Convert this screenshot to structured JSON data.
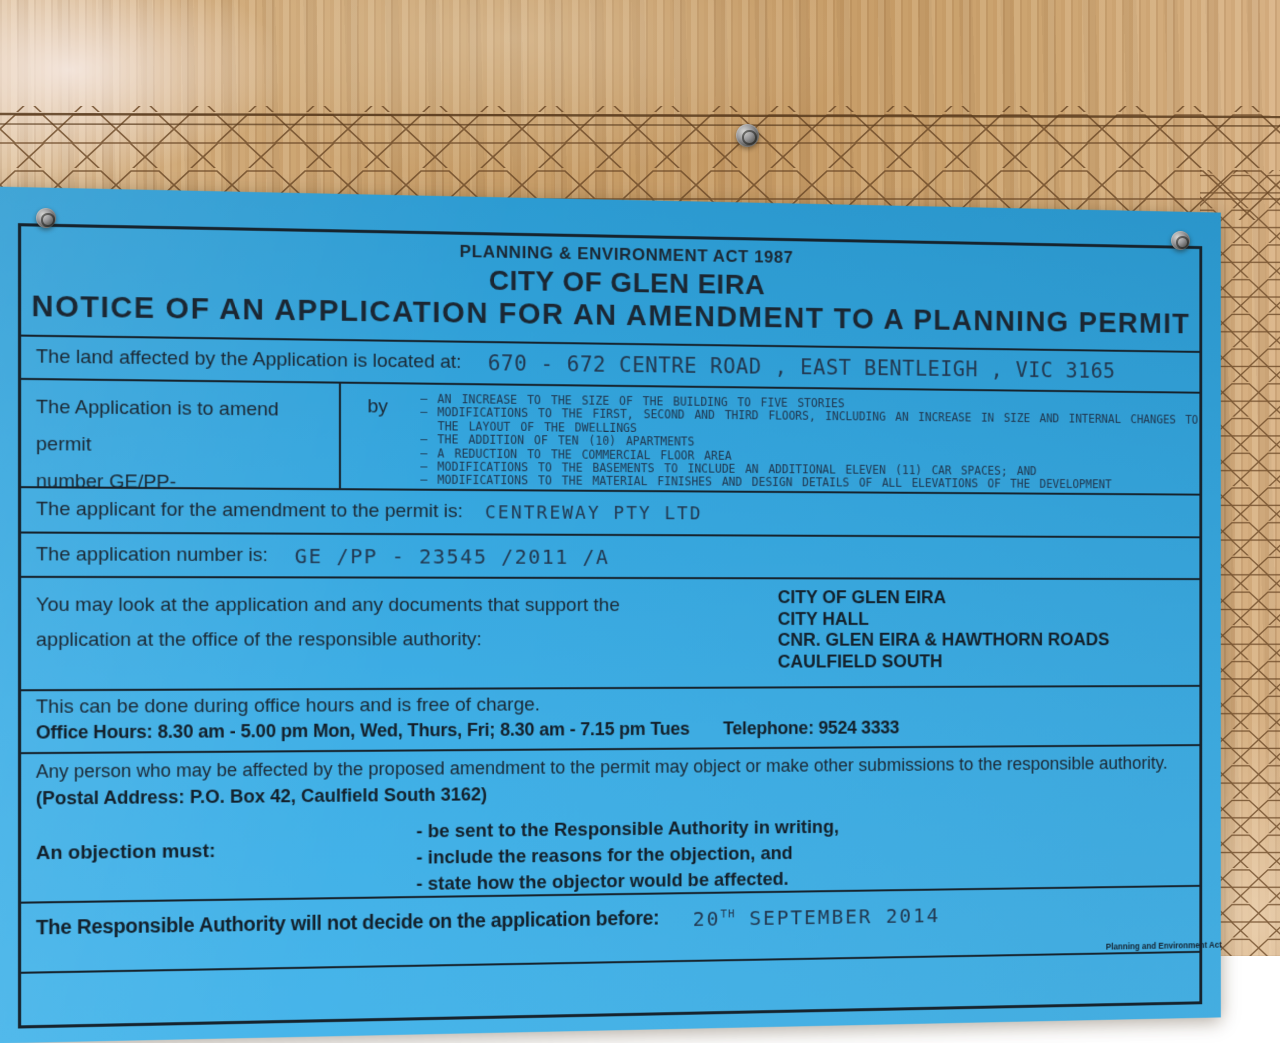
{
  "sign": {
    "header": {
      "act_line": "PLANNING & ENVIRONMENT ACT 1987",
      "city_line": "CITY OF GLEN EIRA",
      "notice_line": "NOTICE OF AN APPLICATION FOR AN AMENDMENT TO A PLANNING PERMIT"
    },
    "land": {
      "label": "The land affected by the Application is located at:",
      "value": "670 - 672  CENTRE ROAD , EAST BENTLEIGH ,  VIC 3165"
    },
    "amendment": {
      "label_line1": "The Application is to amend permit",
      "label_line2": "number GE/PP-",
      "by_label": "by",
      "items": [
        "AN  INCREASE  TO  THE  SIZE  OF  THE  BUILDING  TO  FIVE  STORIES",
        "MODIFICATIONS TO THE FIRST, SECOND AND THIRD FLOORS, INCLUDING AN INCREASE IN SIZE AND INTERNAL CHANGES TO THE LAYOUT OF THE DWELLINGS",
        "THE ADDITION OF TEN (10) APARTMENTS",
        "A REDUCTION TO THE COMMERCIAL FLOOR AREA",
        "MODIFICATIONS TO THE BASEMENTS TO INCLUDE AN ADDITIONAL ELEVEN (11) CAR SPACES; AND",
        "MODIFICATIONS TO THE MATERIAL FINISHES AND DESIGN DETAILS OF ALL ELEVATIONS OF THE DEVELOPMENT"
      ]
    },
    "applicant": {
      "label": "The applicant for the amendment to the permit is:",
      "value": "CENTREWAY  PTY  LTD"
    },
    "application_number": {
      "label": "The application number is:",
      "value": "GE /PP - 23545 /2011 /A"
    },
    "inspection": {
      "label": "You may look at the application and any documents that support the application at the office of the responsible authority:",
      "address_lines": [
        "CITY OF GLEN EIRA",
        "CITY HALL",
        "CNR. GLEN EIRA & HAWTHORN ROADS",
        "CAULFIELD SOUTH"
      ]
    },
    "office": {
      "free_line": "This can be done during office hours and is free of charge.",
      "hours_line": "Office Hours: 8.30 am - 5.00 pm Mon, Wed, Thurs, Fri;  8.30 am - 7.15 pm Tues",
      "telephone": "Telephone: 9524 3333"
    },
    "objection": {
      "affected_line": "Any person who may be affected by the proposed amendment to the permit may object or make other submissions to the responsible authority.",
      "postal_line": "(Postal Address: P.O. Box 42, Caulfield South 3162)",
      "must_label": "An objection must:",
      "must_items": [
        "be sent to the Responsible Authority in writing,",
        "include the reasons for the objection, and",
        "state how the objector would be affected."
      ]
    },
    "decision": {
      "label": "The Responsible Authority will not decide on the application before:",
      "date_day": "20",
      "date_ordinal": "TH",
      "date_rest": " SEPTEMBER  2014"
    },
    "footer_fine_print": "Planning and Environment Act"
  },
  "colors": {
    "sign_blue": "#34a5dd",
    "ink_black": "#16232d",
    "handwriting_ink": "#223850",
    "wood_tan": "#c79e69",
    "wire_brown": "#6b4826"
  }
}
